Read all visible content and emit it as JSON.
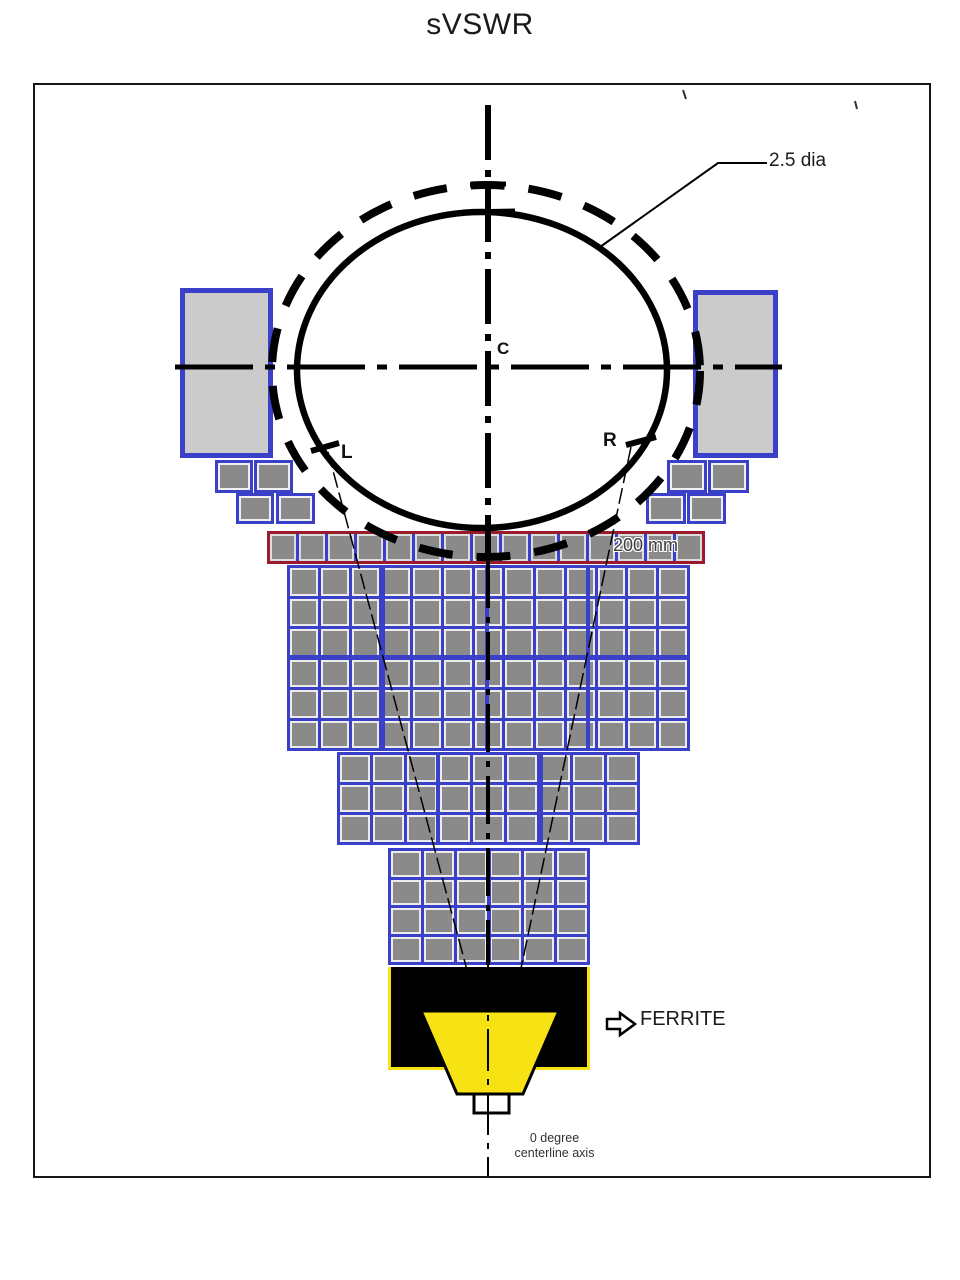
{
  "title": "sVSWR",
  "annotations": {
    "diameter_label": "2.5 dia",
    "center_label": "C",
    "left_label": "L",
    "right_label": "R",
    "row_width_label": "200 mm",
    "ferrite_label": "FERRITE",
    "axis_label_line1": "0 degree",
    "axis_label_line2": "centerline axis"
  },
  "colors": {
    "absorber_grid_blue": "#3a41c8",
    "absorber_tile_gray": "#8a8a8a",
    "side_panel_gray": "#cbcbcb",
    "top_row_border_maroon": "#9b1b2e",
    "horn_yellow": "#f7e214",
    "antenna_body_black": "#000000",
    "line_ink": "#111111"
  },
  "absorber": {
    "top_row_segments": 15,
    "tiers": [
      {
        "name": "upper-absorber-wall",
        "cols": 13,
        "rows": 6
      },
      {
        "name": "middle-absorber-wall",
        "cols": 9,
        "rows": 3
      },
      {
        "name": "lower-absorber-wall",
        "cols": 6,
        "rows": 4
      }
    ],
    "side_step_blocks": 8,
    "side_panels": 2
  }
}
